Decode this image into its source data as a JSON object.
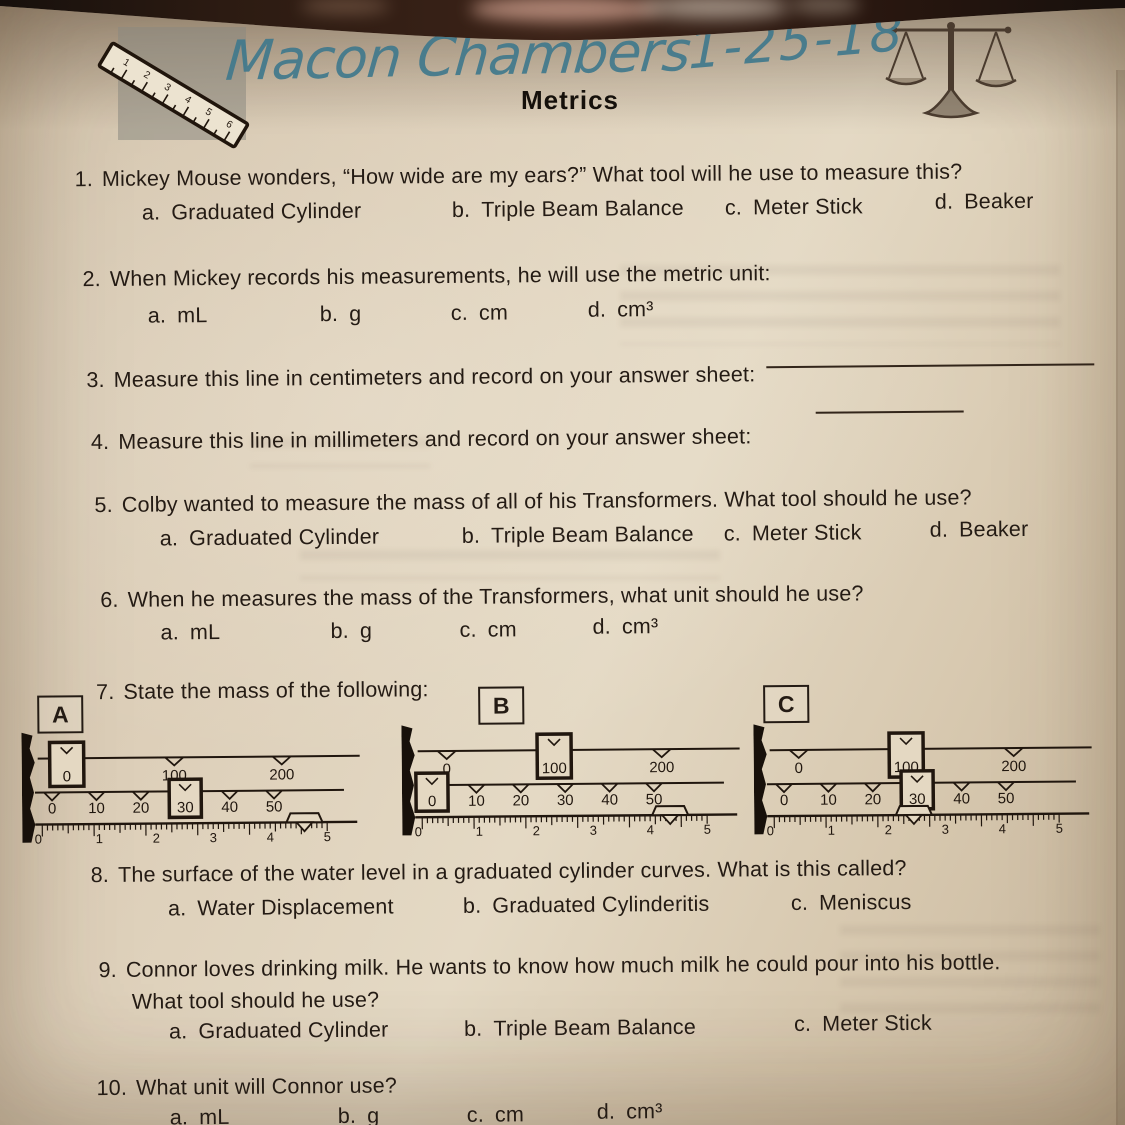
{
  "header": {
    "student_name": "Macon Chambers",
    "date": "1-25-18",
    "title": "Metrics",
    "ruler_clipart_numbers": [
      "1",
      "2",
      "3",
      "4",
      "5",
      "6"
    ],
    "handwriting_color": "#41798c",
    "paper_color": "#ddcfb9",
    "ink_color": "#241b14"
  },
  "questions": [
    {
      "num": "1.",
      "text": "Mickey Mouse wonders, “How wide are my ears?”  What tool will he use to measure this?",
      "options": [
        {
          "letter": "a.",
          "label": "Graduated Cylinder"
        },
        {
          "letter": "b.",
          "label": "Triple Beam Balance"
        },
        {
          "letter": "c.",
          "label": "Meter Stick"
        },
        {
          "letter": "d.",
          "label": "Beaker"
        }
      ]
    },
    {
      "num": "2.",
      "text": "When Mickey records his measurements, he will use the metric unit:",
      "options": [
        {
          "letter": "a.",
          "label": "mL"
        },
        {
          "letter": "b.",
          "label": "g"
        },
        {
          "letter": "c.",
          "label": "cm"
        },
        {
          "letter": "d.",
          "label": "cm³"
        }
      ]
    },
    {
      "num": "3.",
      "text": "Measure this line in centimeters and record on your answer sheet:",
      "answer_blank": ""
    },
    {
      "num": "4.",
      "text": "Measure this line in millimeters and record on your answer sheet:",
      "answer_blank": ""
    },
    {
      "num": "5.",
      "text": "Colby wanted to measure the mass of all of his Transformers.  What tool should he use?",
      "options": [
        {
          "letter": "a.",
          "label": "Graduated Cylinder"
        },
        {
          "letter": "b.",
          "label": "Triple Beam Balance"
        },
        {
          "letter": "c.",
          "label": "Meter Stick"
        },
        {
          "letter": "d.",
          "label": "Beaker"
        }
      ]
    },
    {
      "num": "6.",
      "text": "When he measures the mass of the Transformers, what unit should he use?",
      "options": [
        {
          "letter": "a.",
          "label": "mL"
        },
        {
          "letter": "b.",
          "label": "g"
        },
        {
          "letter": "c.",
          "label": "cm"
        },
        {
          "letter": "d.",
          "label": "cm³"
        }
      ]
    },
    {
      "num": "7.",
      "text": "State the mass of the following:"
    },
    {
      "num": "8.",
      "text": "The surface of the water level in a graduated cylinder curves.  What is this called?",
      "options": [
        {
          "letter": "a.",
          "label": "Water Displacement"
        },
        {
          "letter": "b.",
          "label": "Graduated Cylinderitis"
        },
        {
          "letter": "c.",
          "label": "Meniscus"
        }
      ]
    },
    {
      "num": "9.",
      "text": "Connor loves drinking milk.  He wants to know how much milk he could pour into his bottle.",
      "text2": "What tool should he use?",
      "options": [
        {
          "letter": "a.",
          "label": "Graduated Cylinder"
        },
        {
          "letter": "b.",
          "label": "Triple Beam Balance"
        },
        {
          "letter": "c.",
          "label": "Meter Stick"
        }
      ]
    },
    {
      "num": "10.",
      "text": "What unit will Connor use?",
      "options": [
        {
          "letter": "a.",
          "label": "mL"
        },
        {
          "letter": "b.",
          "label": "g"
        },
        {
          "letter": "c.",
          "label": "cm"
        },
        {
          "letter": "d.",
          "label": "cm³"
        }
      ]
    }
  ],
  "question7": {
    "balances": [
      {
        "label": "A",
        "top_ticks": [
          0,
          100,
          200
        ],
        "middle_ticks": [
          0,
          10,
          20,
          30,
          40,
          50
        ],
        "ruler_ticks": [
          0,
          1,
          2,
          3,
          4,
          5
        ],
        "top_rider": 0,
        "middle_rider": 30,
        "ruler_pointer": 4.6
      },
      {
        "label": "B",
        "top_ticks": [
          0,
          100,
          200
        ],
        "middle_ticks": [
          0,
          10,
          20,
          30,
          40,
          50
        ],
        "ruler_ticks": [
          0,
          1,
          2,
          3,
          4,
          5
        ],
        "top_rider": 100,
        "middle_rider": 0,
        "ruler_pointer": 4.35
      },
      {
        "label": "C",
        "top_ticks": [
          0,
          100,
          200
        ],
        "middle_ticks": [
          0,
          10,
          20,
          30,
          40,
          50
        ],
        "ruler_ticks": [
          0,
          1,
          2,
          3,
          4,
          5
        ],
        "top_rider": 100,
        "middle_rider": 30,
        "ruler_pointer": 2.45
      }
    ]
  }
}
